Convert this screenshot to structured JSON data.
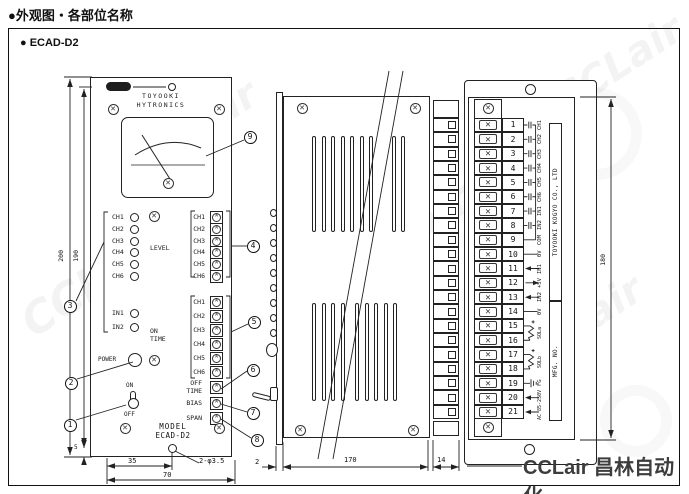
{
  "header": {
    "title": "●外观图・各部位名称"
  },
  "frame": {
    "label": "● ECAD-D2"
  },
  "watermark": {
    "text": "CCLair",
    "footer": "CCLair 昌林自动化"
  },
  "front_view": {
    "brand": [
      "TOYOOKI",
      "HYTRONICS"
    ],
    "leds": [
      "CH1",
      "CH2",
      "CH3",
      "CH4",
      "CH5",
      "CH6"
    ],
    "inputs": [
      "IN1",
      "IN2"
    ],
    "groups": [
      {
        "label": [
          "LEVEL"
        ],
        "channels": [
          "CH1",
          "CH2",
          "CH3",
          "CH4",
          "CH5",
          "CH6"
        ]
      },
      {
        "label": [
          "ON",
          "TIME"
        ],
        "channels": [
          "CH1",
          "CH2",
          "CH3",
          "CH4",
          "CH5",
          "CH6"
        ]
      }
    ],
    "single_pots": [
      {
        "label": [
          "OFF",
          "TIME"
        ]
      },
      {
        "label": [
          "BIAS"
        ]
      },
      {
        "label": [
          "SPAN"
        ]
      }
    ],
    "power": "POWER",
    "switch_on": "ON",
    "switch_off": "OFF",
    "model": [
      "MODEL",
      "ECAD-D2"
    ],
    "dims": {
      "h200": "200",
      "h190": "190",
      "b5": "5",
      "w35": "35",
      "w70": "70",
      "hole": "2-φ3.5"
    }
  },
  "side_view": {
    "dims": {
      "front": "2",
      "depth": "170",
      "terminal": "14"
    }
  },
  "rear_view": {
    "dims": {
      "height": "180"
    },
    "plate": {
      "maker": "TOYOOKI KOGYO CO., LTD",
      "mfg": "MFG. NO."
    },
    "terminals": [
      {
        "no": "1",
        "label": "CH1",
        "sym": "contact"
      },
      {
        "no": "2",
        "label": "CH2",
        "sym": "contact"
      },
      {
        "no": "3",
        "label": "CH3",
        "sym": "contact"
      },
      {
        "no": "4",
        "label": "CH4",
        "sym": "contact"
      },
      {
        "no": "5",
        "label": "CH5",
        "sym": "contact"
      },
      {
        "no": "6",
        "label": "CH6",
        "sym": "contact"
      },
      {
        "no": "7",
        "label": "IN1",
        "sym": "contact"
      },
      {
        "no": "8",
        "label": "IN2",
        "sym": "contact"
      },
      {
        "no": "9",
        "label": "COM",
        "sym": "bus-end"
      },
      {
        "no": "10",
        "label": "0V",
        "sym": "line"
      },
      {
        "no": "11",
        "label": "IN1",
        "sym": "arrow-in"
      },
      {
        "no": "12",
        "label": "+5V",
        "sym": "arrow-out"
      },
      {
        "no": "13",
        "label": "IN2",
        "sym": "arrow-in"
      },
      {
        "no": "14",
        "label": "0V",
        "sym": "line"
      },
      {
        "no": "15",
        "label": "",
        "sym": "coil-top"
      },
      {
        "no": "16",
        "label": "",
        "sym": "coil-bottom"
      },
      {
        "no": "17",
        "label": "",
        "sym": "coil-top"
      },
      {
        "no": "18",
        "label": "",
        "sym": "coil-bottom"
      },
      {
        "no": "19",
        "label": "FG",
        "sym": "ground"
      },
      {
        "no": "20",
        "label": "",
        "sym": "arrow-in"
      },
      {
        "no": "21",
        "label": "",
        "sym": "arrow-in"
      }
    ],
    "pair_labels": [
      {
        "text": "SOLa",
        "rows": [
          15,
          16
        ]
      },
      {
        "text": "SOLb",
        "rows": [
          17,
          18
        ]
      },
      {
        "text": "AC 85-250V",
        "rows": [
          20,
          21
        ]
      }
    ]
  },
  "callouts": [
    {
      "n": "1",
      "target": "power-switch"
    },
    {
      "n": "2",
      "target": "power-lamp"
    },
    {
      "n": "3",
      "target": "indicator-leds"
    },
    {
      "n": "4",
      "target": "level-pots"
    },
    {
      "n": "5",
      "target": "on-time-pots"
    },
    {
      "n": "6",
      "target": "off-time-pot"
    },
    {
      "n": "7",
      "target": "bias-pot"
    },
    {
      "n": "8",
      "target": "span-pot"
    },
    {
      "n": "9",
      "target": "meter"
    }
  ]
}
